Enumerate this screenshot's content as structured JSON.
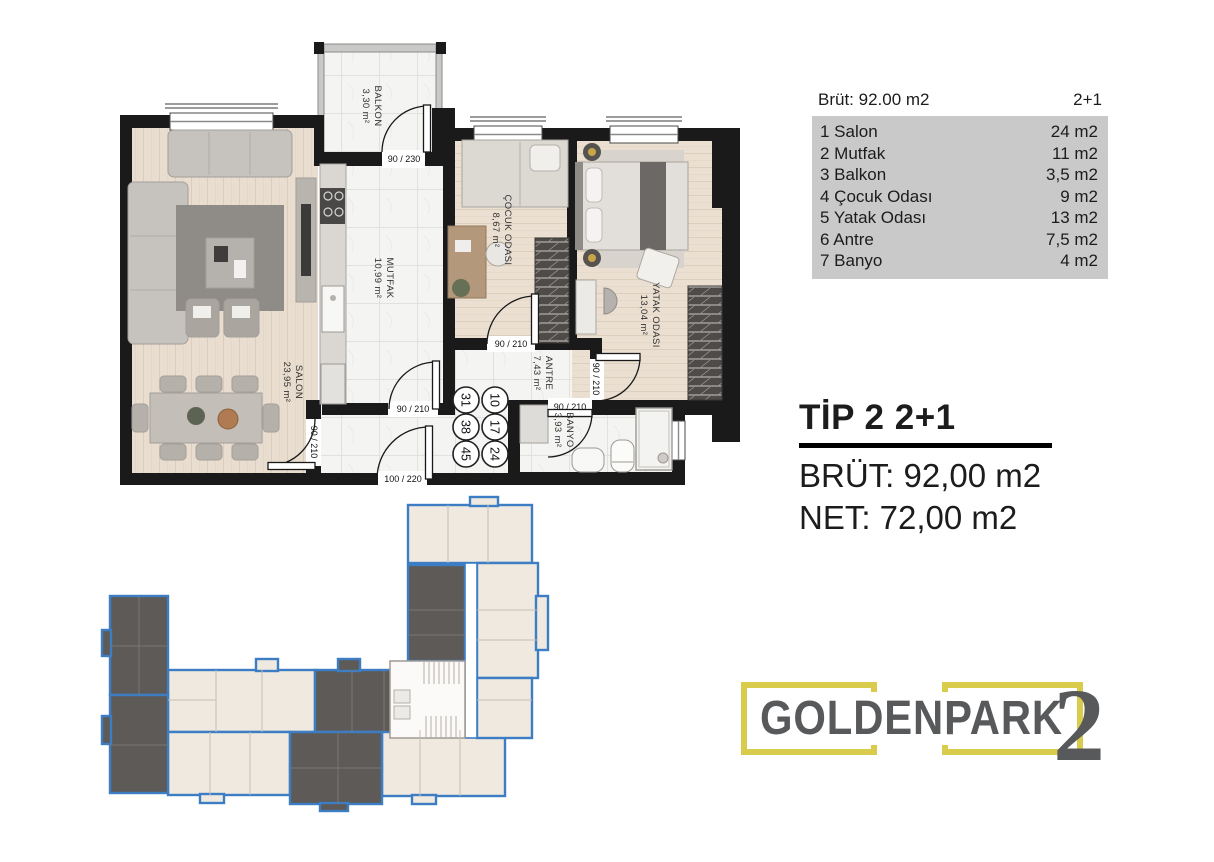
{
  "colors": {
    "wall": "#1a1a1a",
    "wood_floor": "#e8ddcf",
    "marble_floor": "#f4f4f2",
    "accent_yellow": "#d9cb4c",
    "logo_gray": "#58595b",
    "table_gray": "#c9c9c9",
    "site_plan_blue": "#3c7dc4",
    "site_plan_dark_unit": "#5d5a57",
    "site_plan_light_unit": "#efe9df"
  },
  "info_table": {
    "header_left": "Brüt: 92.00 m2",
    "header_right": "2+1",
    "rows": [
      {
        "label": "1 Salon",
        "value": "24 m2"
      },
      {
        "label": "2 Mutfak",
        "value": "11 m2"
      },
      {
        "label": "3 Balkon",
        "value": "3,5 m2"
      },
      {
        "label": "4 Çocuk Odası",
        "value": "9 m2"
      },
      {
        "label": "5 Yatak Odası",
        "value": "13 m2"
      },
      {
        "label": "6 Antre",
        "value": "7,5 m2"
      },
      {
        "label": "7 Banyo",
        "value": "4 m2"
      }
    ]
  },
  "title_block": {
    "title": "TİP 2 2+1",
    "brut": "BRÜT: 92,00 m2",
    "net": "NET: 72,00 m2"
  },
  "logo": {
    "name": "GOLDENPARK",
    "number": "2"
  },
  "floor_plan": {
    "rooms": {
      "balkon": {
        "name": "BALKON",
        "area": "3,30 m²"
      },
      "salon": {
        "name": "SALON",
        "area": "23,95 m²"
      },
      "mutfak": {
        "name": "MUTFAK",
        "area": "10,99 m²"
      },
      "cocuk": {
        "name": "ÇOCUK ODASI",
        "area": "8,67 m²"
      },
      "yatak": {
        "name": "YATAK ODASI",
        "area": "13,04 m²"
      },
      "antre": {
        "name": "ANTRE",
        "area": "7,43 m²"
      },
      "banyo": {
        "name": "BANYO",
        "area": "3,93 m²"
      }
    },
    "doors": {
      "balkon": "90 / 230",
      "mutfak": "90 / 210",
      "salon": "90 / 210",
      "cocuk": "90 / 210",
      "yatak": "90 / 210",
      "banyo": "90 / 210",
      "entry": "100 / 220"
    },
    "unit_circles": {
      "left": [
        "31",
        "38",
        "45"
      ],
      "right": [
        "10",
        "17",
        "24"
      ]
    }
  }
}
